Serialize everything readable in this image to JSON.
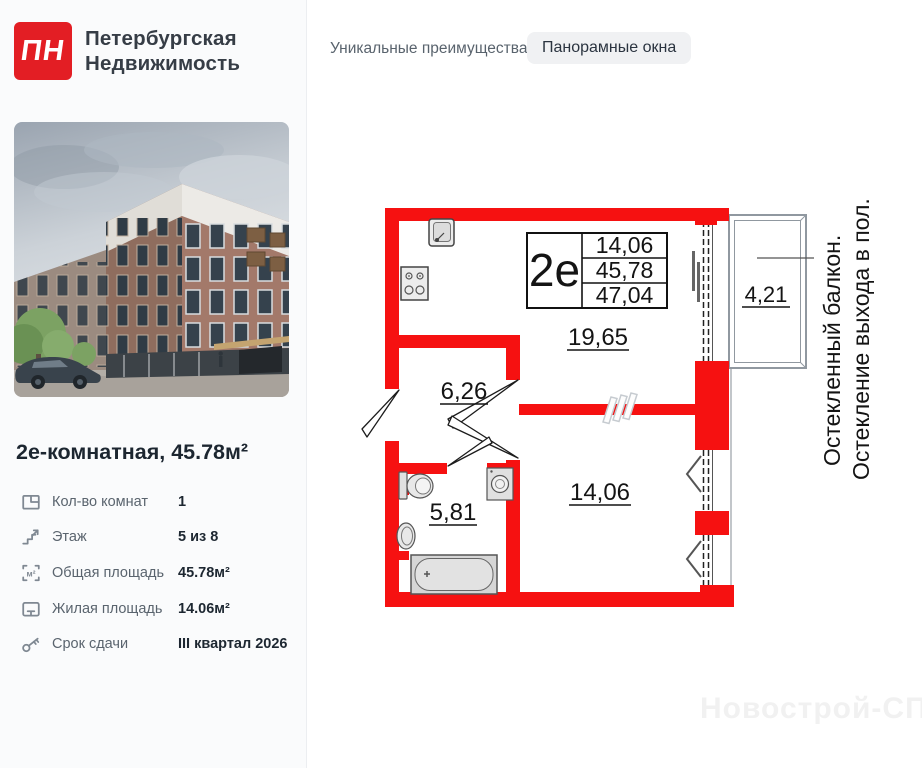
{
  "brand": {
    "logo_abbr": "ПН",
    "name_line1": "Петербургская",
    "name_line2": "Недвижимость",
    "brand_red": "#e31e24"
  },
  "header": {
    "advantages_label": "Уникальные преимущества",
    "advantage_badge": "Панорамные окна"
  },
  "listing": {
    "title": "2е-комнатная, 45.78м²",
    "area_icon_glyph": "м²",
    "details": [
      {
        "icon": "rooms-icon",
        "label": "Кол-во комнат",
        "value": "1"
      },
      {
        "icon": "floor-icon",
        "label": "Этаж",
        "value": "5 из 8"
      },
      {
        "icon": "total-area-icon",
        "label": "Общая площадь",
        "value": "45.78м²"
      },
      {
        "icon": "living-area-icon",
        "label": "Жилая площадь",
        "value": "14.06м²"
      },
      {
        "icon": "key-icon",
        "label": "Срок сдачи",
        "value": "III квартал 2026"
      }
    ]
  },
  "floorplan": {
    "unit_code": "2е",
    "wall_color": "#f61111",
    "table": {
      "living_area": "14,06",
      "area_no_balcony": "45,78",
      "total_area": "47,04"
    },
    "rooms": {
      "kitchen_living": "19,65",
      "hallway": "6,26",
      "bathroom": "5,81",
      "bedroom": "14,06",
      "balcony": "4,21"
    },
    "annotations": {
      "line1": "Остекленный балкон.",
      "line2": "Остекление выхода в пол."
    }
  },
  "watermark": "Новострой-СПб"
}
